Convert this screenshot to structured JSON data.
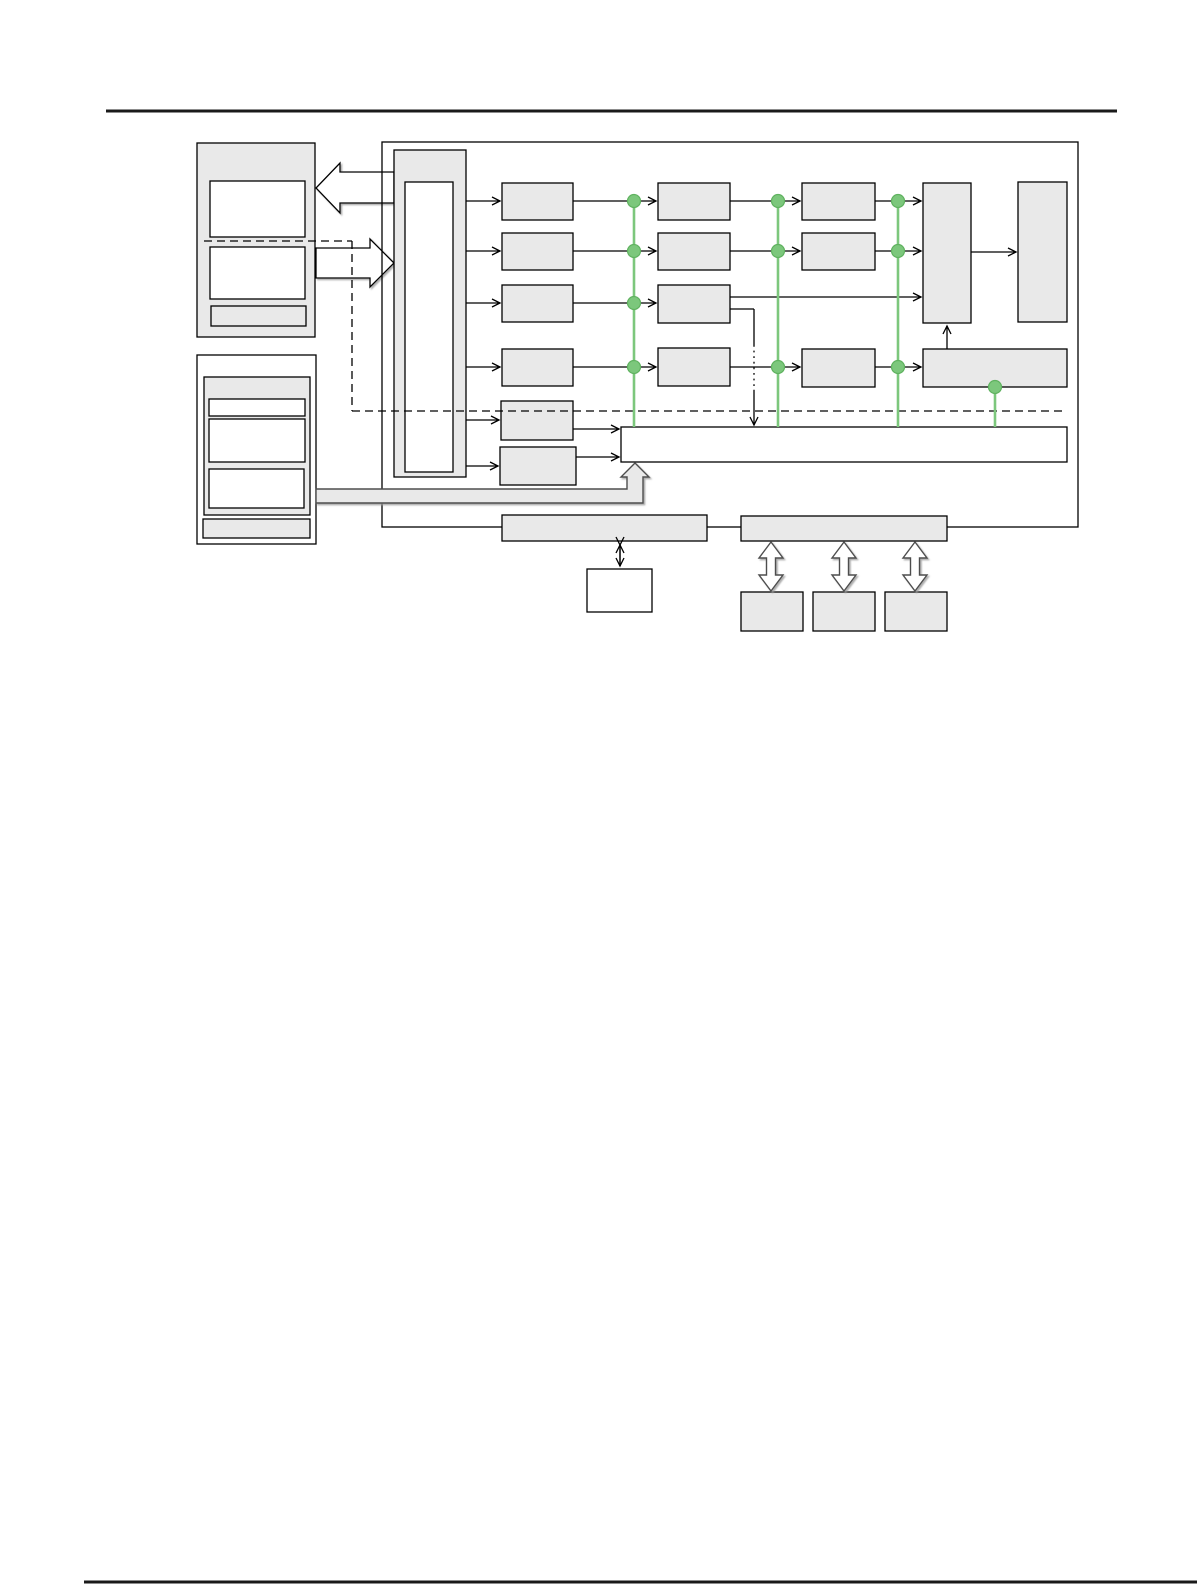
{
  "page": {
    "width": 1201,
    "height": 1585,
    "background": "#ffffff",
    "rules": [
      {
        "name": "header-rule",
        "x1": 106,
        "y1": 111,
        "x2": 1117,
        "y2": 111,
        "width": 3,
        "color": "#1a1a1a"
      },
      {
        "name": "footer-rule",
        "x1": 84,
        "y1": 1582,
        "x2": 1197,
        "y2": 1582,
        "width": 3,
        "color": "#1a1a1a"
      }
    ]
  },
  "colors": {
    "box_fill": "#E9E9E9",
    "box_stroke": "#000000",
    "white": "#FFFFFF",
    "green": "#7CC77C",
    "green_edge": "#5FB25F",
    "pipe_stroke": "#4D4D4D",
    "dash_color": "#000000"
  },
  "diagram": {
    "frame": {
      "name": "main-frame",
      "x": 382,
      "y": 142,
      "w": 696,
      "h": 385
    },
    "nodes": [
      {
        "name": "left-panel-top",
        "x": 197,
        "y": 143,
        "w": 118,
        "h": 194,
        "fill": "gray"
      },
      {
        "name": "left-panel-top-box-a",
        "x": 210,
        "y": 181,
        "w": 95,
        "h": 56,
        "fill": "white"
      },
      {
        "name": "left-panel-top-box-b",
        "x": 210,
        "y": 247,
        "w": 95,
        "h": 52,
        "fill": "white"
      },
      {
        "name": "left-panel-top-strip",
        "x": 211,
        "y": 306,
        "w": 95,
        "h": 20,
        "fill": "gray"
      },
      {
        "name": "left-panel-bottom",
        "x": 197,
        "y": 355,
        "w": 119,
        "h": 189,
        "fill": "white"
      },
      {
        "name": "left-panel-bottom-inner",
        "x": 204,
        "y": 377,
        "w": 106,
        "h": 138,
        "fill": "gray"
      },
      {
        "name": "left-panel-bottom-slot-a",
        "x": 209,
        "y": 399,
        "w": 96,
        "h": 17,
        "fill": "white"
      },
      {
        "name": "left-panel-bottom-slot-b",
        "x": 209,
        "y": 419,
        "w": 96,
        "h": 43,
        "fill": "white"
      },
      {
        "name": "left-panel-bottom-slot-c",
        "x": 209,
        "y": 469,
        "w": 95,
        "h": 39,
        "fill": "white"
      },
      {
        "name": "left-panel-bottom-strip",
        "x": 203,
        "y": 519,
        "w": 107,
        "h": 19,
        "fill": "gray"
      },
      {
        "name": "core-column",
        "x": 394,
        "y": 150,
        "w": 72,
        "h": 327,
        "fill": "gray"
      },
      {
        "name": "core-column-inner",
        "x": 405,
        "y": 182,
        "w": 48,
        "h": 290,
        "fill": "white"
      },
      {
        "name": "stage1-row1",
        "x": 502,
        "y": 183,
        "w": 71,
        "h": 37,
        "fill": "gray"
      },
      {
        "name": "stage1-row2",
        "x": 502,
        "y": 233,
        "w": 71,
        "h": 37,
        "fill": "gray"
      },
      {
        "name": "stage1-row3",
        "x": 502,
        "y": 285,
        "w": 71,
        "h": 37,
        "fill": "gray"
      },
      {
        "name": "stage1-row4",
        "x": 502,
        "y": 349,
        "w": 71,
        "h": 37,
        "fill": "gray"
      },
      {
        "name": "stage1-row5",
        "x": 501,
        "y": 401,
        "w": 72,
        "h": 39,
        "fill": "gray"
      },
      {
        "name": "stage1-row6",
        "x": 500,
        "y": 447,
        "w": 76,
        "h": 38,
        "fill": "gray"
      },
      {
        "name": "stage2-row1",
        "x": 658,
        "y": 183,
        "w": 72,
        "h": 37,
        "fill": "gray"
      },
      {
        "name": "stage2-row2",
        "x": 658,
        "y": 233,
        "w": 72,
        "h": 37,
        "fill": "gray"
      },
      {
        "name": "stage2-row3",
        "x": 658,
        "y": 285,
        "w": 72,
        "h": 38,
        "fill": "gray"
      },
      {
        "name": "stage2-row4",
        "x": 658,
        "y": 348,
        "w": 72,
        "h": 38,
        "fill": "gray"
      },
      {
        "name": "stage3-row1",
        "x": 802,
        "y": 183,
        "w": 73,
        "h": 37,
        "fill": "gray"
      },
      {
        "name": "stage3-row2",
        "x": 802,
        "y": 233,
        "w": 73,
        "h": 37,
        "fill": "gray"
      },
      {
        "name": "stage3-row4",
        "x": 802,
        "y": 349,
        "w": 73,
        "h": 38,
        "fill": "gray"
      },
      {
        "name": "collector-left",
        "x": 923,
        "y": 183,
        "w": 48,
        "h": 140,
        "fill": "gray"
      },
      {
        "name": "collector-right",
        "x": 1018,
        "y": 182,
        "w": 49,
        "h": 140,
        "fill": "gray"
      },
      {
        "name": "accumulator-bar",
        "x": 923,
        "y": 349,
        "w": 144,
        "h": 38,
        "fill": "gray"
      },
      {
        "name": "bus-bar",
        "x": 621,
        "y": 427,
        "w": 446,
        "h": 35,
        "fill": "white"
      },
      {
        "name": "io-bar-left",
        "x": 502,
        "y": 515,
        "w": 205,
        "h": 26,
        "fill": "gray"
      },
      {
        "name": "io-bar-right",
        "x": 741,
        "y": 516,
        "w": 206,
        "h": 25,
        "fill": "gray"
      },
      {
        "name": "memory-box",
        "x": 587,
        "y": 569,
        "w": 65,
        "h": 43,
        "fill": "white"
      },
      {
        "name": "port-a",
        "x": 741,
        "y": 592,
        "w": 62,
        "h": 39,
        "fill": "gray"
      },
      {
        "name": "port-b",
        "x": 813,
        "y": 592,
        "w": 62,
        "h": 39,
        "fill": "gray"
      },
      {
        "name": "port-c",
        "x": 885,
        "y": 592,
        "w": 62,
        "h": 39,
        "fill": "gray"
      }
    ],
    "arrows_back": [
      {
        "name": "block-arrow-left",
        "fill": "white",
        "points": [
          [
            394,
            172
          ],
          [
            340,
            172
          ],
          [
            340,
            163
          ],
          [
            316,
            188
          ],
          [
            340,
            213
          ],
          [
            340,
            203
          ],
          [
            394,
            203
          ]
        ]
      },
      {
        "name": "block-arrow-right",
        "fill": "white",
        "points": [
          [
            316,
            248
          ],
          [
            370,
            248
          ],
          [
            370,
            239
          ],
          [
            394,
            263
          ],
          [
            370,
            287
          ],
          [
            370,
            278
          ],
          [
            316,
            278
          ]
        ]
      }
    ],
    "arrows_front": [
      {
        "name": "pipe-up-arrow",
        "fill": "gray",
        "points": [
          [
            316,
            489
          ],
          [
            627,
            489
          ],
          [
            627,
            477
          ],
          [
            621,
            477
          ],
          [
            635,
            463
          ],
          [
            649,
            477
          ],
          [
            643,
            477
          ],
          [
            643,
            503
          ],
          [
            316,
            503
          ]
        ]
      },
      {
        "name": "double-arrow-a",
        "fill": "white",
        "points": [
          [
            771,
            542
          ],
          [
            783,
            558
          ],
          [
            775.5,
            558
          ],
          [
            775.5,
            575
          ],
          [
            783,
            575
          ],
          [
            771,
            591
          ],
          [
            759,
            575
          ],
          [
            766.5,
            575
          ],
          [
            766.5,
            558
          ],
          [
            759,
            558
          ]
        ]
      },
      {
        "name": "double-arrow-b",
        "fill": "white",
        "points": [
          [
            844,
            542
          ],
          [
            856,
            558
          ],
          [
            848.5,
            558
          ],
          [
            848.5,
            575
          ],
          [
            856,
            575
          ],
          [
            844,
            591
          ],
          [
            832,
            575
          ],
          [
            839.5,
            575
          ],
          [
            839.5,
            558
          ],
          [
            832,
            558
          ]
        ]
      },
      {
        "name": "double-arrow-c",
        "fill": "white",
        "points": [
          [
            915,
            542
          ],
          [
            927,
            558
          ],
          [
            919.5,
            558
          ],
          [
            919.5,
            575
          ],
          [
            927,
            575
          ],
          [
            915,
            591
          ],
          [
            903,
            575
          ],
          [
            910.5,
            575
          ],
          [
            910.5,
            558
          ],
          [
            903,
            558
          ]
        ]
      }
    ],
    "connectors": [
      {
        "name": "core-to-s1r1",
        "x1": 466,
        "y1": 201,
        "x2": 500,
        "y2": 201,
        "arrow": "end"
      },
      {
        "name": "core-to-s1r2",
        "x1": 466,
        "y1": 251,
        "x2": 500,
        "y2": 251,
        "arrow": "end"
      },
      {
        "name": "core-to-s1r3",
        "x1": 466,
        "y1": 303,
        "x2": 500,
        "y2": 303,
        "arrow": "end"
      },
      {
        "name": "core-to-s1r4",
        "x1": 466,
        "y1": 367,
        "x2": 500,
        "y2": 367,
        "arrow": "end"
      },
      {
        "name": "core-to-s1r5",
        "x1": 466,
        "y1": 420,
        "x2": 499,
        "y2": 420,
        "arrow": "end"
      },
      {
        "name": "core-to-s1r6",
        "x1": 466,
        "y1": 466,
        "x2": 498,
        "y2": 466,
        "arrow": "end"
      },
      {
        "name": "s1r1-to-s2r1",
        "x1": 573,
        "y1": 201,
        "x2": 656,
        "y2": 201,
        "arrow": "end"
      },
      {
        "name": "s1r2-to-s2r2",
        "x1": 573,
        "y1": 251,
        "x2": 656,
        "y2": 251,
        "arrow": "end"
      },
      {
        "name": "s1r3-to-s2r3",
        "x1": 573,
        "y1": 303,
        "x2": 656,
        "y2": 303,
        "arrow": "end"
      },
      {
        "name": "s1r4-to-s2r4",
        "x1": 573,
        "y1": 367,
        "x2": 656,
        "y2": 367,
        "arrow": "end"
      },
      {
        "name": "s2r1-to-s3r1",
        "x1": 730,
        "y1": 201,
        "x2": 800,
        "y2": 201,
        "arrow": "end"
      },
      {
        "name": "s2r2-to-s3r2",
        "x1": 730,
        "y1": 251,
        "x2": 800,
        "y2": 251,
        "arrow": "end"
      },
      {
        "name": "s2r4-to-s3r4",
        "x1": 730,
        "y1": 367,
        "x2": 800,
        "y2": 367,
        "arrow": "end"
      },
      {
        "name": "s3r1-to-collector",
        "x1": 875,
        "y1": 201,
        "x2": 921,
        "y2": 201,
        "arrow": "end"
      },
      {
        "name": "s3r2-to-collector",
        "x1": 875,
        "y1": 251,
        "x2": 921,
        "y2": 251,
        "arrow": "end"
      },
      {
        "name": "s3r4-to-accumulator",
        "x1": 875,
        "y1": 367,
        "x2": 921,
        "y2": 367,
        "arrow": "end"
      },
      {
        "name": "s2r3-to-collector",
        "x1": 730,
        "y1": 297,
        "x2": 921,
        "y2": 297,
        "arrow": "end"
      },
      {
        "name": "collector-to-collector2",
        "x1": 971,
        "y1": 252,
        "x2": 1016,
        "y2": 252,
        "arrow": "end"
      },
      {
        "name": "accumulator-to-collector",
        "x1": 947,
        "y1": 349,
        "x2": 947,
        "y2": 326,
        "arrow": "end"
      },
      {
        "name": "s1r5-to-bus",
        "x1": 573,
        "y1": 429,
        "x2": 619,
        "y2": 429,
        "arrow": "end"
      },
      {
        "name": "s1r6-to-bus",
        "x1": 576,
        "y1": 457,
        "x2": 619,
        "y2": 457,
        "arrow": "end"
      },
      {
        "name": "s2r3-branch-h",
        "x1": 730,
        "y1": 309,
        "x2": 754,
        "y2": 309
      },
      {
        "name": "s2r3-branch-v1",
        "x1": 754,
        "y1": 309,
        "x2": 754,
        "y2": 345
      },
      {
        "name": "s2r3-branch-v2",
        "x1": 754,
        "y1": 345,
        "x2": 754,
        "y2": 390,
        "style": "dotted"
      },
      {
        "name": "s2r3-branch-v3",
        "x1": 754,
        "y1": 390,
        "x2": 754,
        "y2": 425,
        "arrow": "end"
      },
      {
        "name": "iobar-memory-link",
        "x1": 620,
        "y1": 545,
        "x2": 620,
        "y2": 566,
        "arrow": "both"
      },
      {
        "name": "dashed-path-h1",
        "x1": 204,
        "y1": 241,
        "x2": 352,
        "y2": 241,
        "style": "dashed"
      },
      {
        "name": "dashed-path-v",
        "x1": 352,
        "y1": 241,
        "x2": 352,
        "y2": 411,
        "style": "dashed"
      },
      {
        "name": "dashed-path-h2",
        "x1": 352,
        "y1": 411,
        "x2": 1063,
        "y2": 411,
        "style": "dashed"
      }
    ],
    "green_lines": [
      {
        "name": "tap-line-1",
        "x1": 634,
        "y1": 202,
        "x2": 634,
        "y2": 427
      },
      {
        "name": "tap-line-2",
        "x1": 778,
        "y1": 202,
        "x2": 778,
        "y2": 427
      },
      {
        "name": "tap-line-3",
        "x1": 898,
        "y1": 202,
        "x2": 898,
        "y2": 427
      },
      {
        "name": "tap-line-4",
        "x1": 995,
        "y1": 387,
        "x2": 995,
        "y2": 427
      }
    ],
    "green_dots": [
      {
        "x": 634,
        "y": 201
      },
      {
        "x": 634,
        "y": 251
      },
      {
        "x": 634,
        "y": 303
      },
      {
        "x": 634,
        "y": 367
      },
      {
        "x": 778,
        "y": 201
      },
      {
        "x": 778,
        "y": 251
      },
      {
        "x": 778,
        "y": 367
      },
      {
        "x": 898,
        "y": 201
      },
      {
        "x": 898,
        "y": 251
      },
      {
        "x": 898,
        "y": 367
      },
      {
        "x": 995,
        "y": 387
      }
    ]
  }
}
